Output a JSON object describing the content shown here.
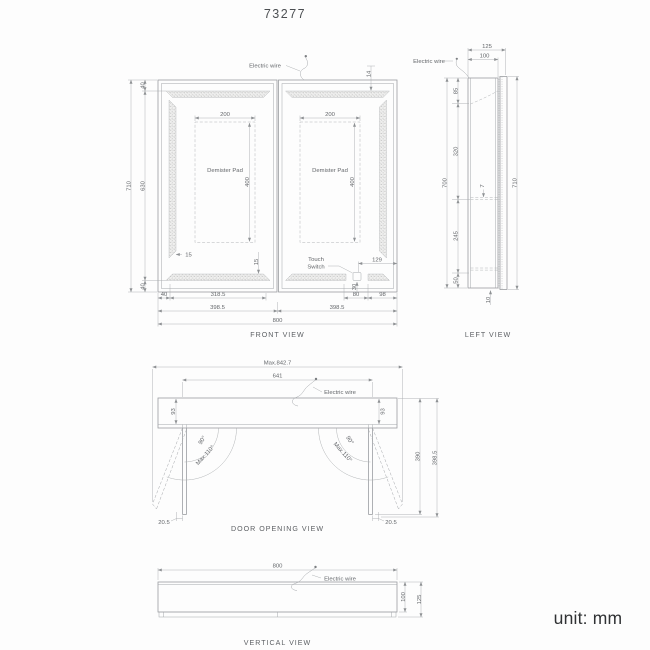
{
  "title": "73277",
  "unit_note": "unit: mm",
  "shared": {
    "electric_wire": "Electric wire",
    "demister_pad": "Demister Pad"
  },
  "front_view": {
    "caption": "FRONT VIEW",
    "touch_switch": {
      "line1": "Touch",
      "line2": "Switch"
    },
    "dims": {
      "overall_width": "800",
      "door_width_left": "398.5",
      "door_width_right": "398.5",
      "overall_height": "710",
      "inner_height": "630",
      "margin_top": "40",
      "margin_bottom": "40",
      "bottom_margin_left": "40",
      "seg_318_5": "318.5",
      "seg_80": "80",
      "seg_98": "98",
      "switch_offset": "129",
      "switch_height": "30",
      "led_top_offset": "14",
      "led_side_inset": "15",
      "led_bottom_inset": "15",
      "pad_width": "200",
      "pad_height": "400"
    }
  },
  "left_view": {
    "caption": "LEFT VIEW",
    "dims": {
      "depth_overall": "125",
      "depth_body": "100",
      "height_body": "700",
      "height_door": "710",
      "seg_top": "85",
      "seg_upper": "320",
      "seg_lower": "245",
      "seg_bottom": "50",
      "shelf_thickness": "7",
      "bottom_offset": "10"
    }
  },
  "door_opening_view": {
    "caption": "DOOR OPENING VIEW",
    "dims": {
      "max_width": "Max.842.7",
      "inner_width": "641",
      "depth_left": "93",
      "depth_right": "93",
      "angle_open": "90°",
      "angle_max": "Max.110°",
      "tip_offset_left": "20.5",
      "tip_offset_right": "20.5",
      "door_height": "390",
      "door_width": "398.5"
    }
  },
  "vertical_view": {
    "caption": "VERTICAL VIEW",
    "dims": {
      "width": "800",
      "depth_body": "100",
      "depth_overall": "125"
    }
  }
}
